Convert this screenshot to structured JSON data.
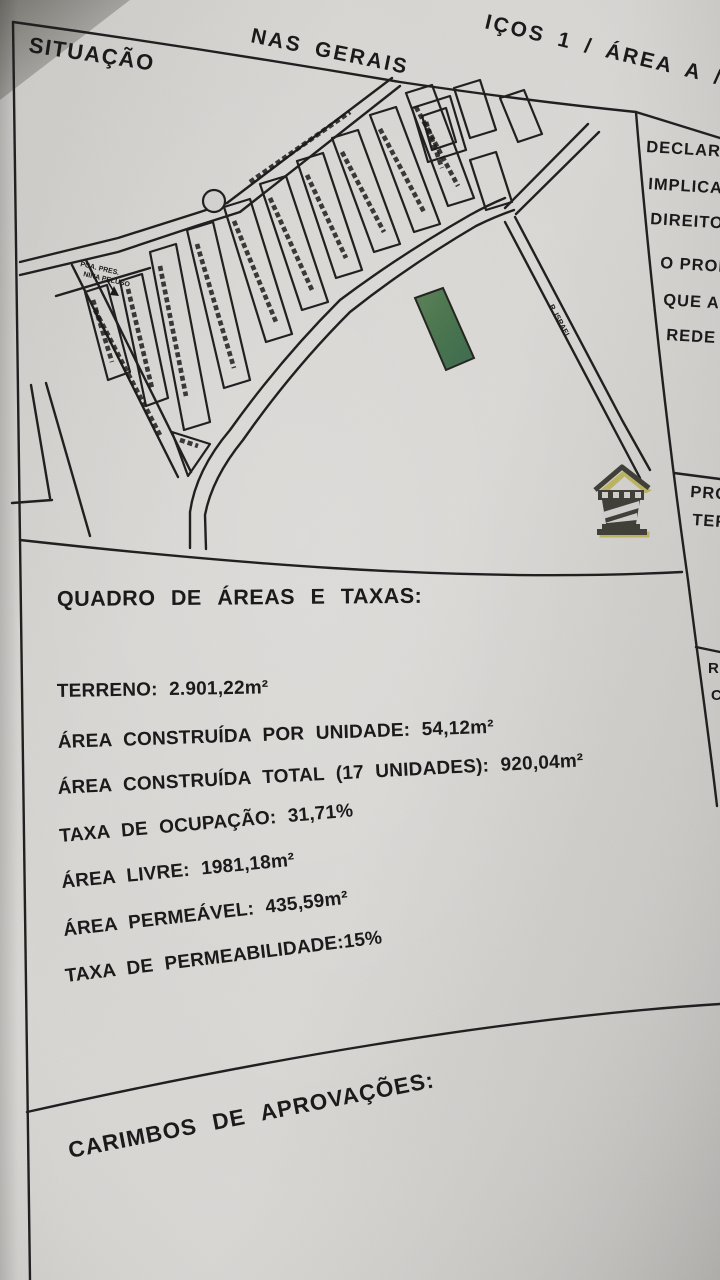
{
  "header": {
    "left_fragment": "NAS GERAIS",
    "right_fragment": "IÇOS 1 / ÁREA A / AV",
    "section_label": "SITUAÇÃO"
  },
  "side_notes": {
    "declaration_lines": [
      "DECLARO",
      "IMPLICA",
      "DIREITO"
    ],
    "owner_lines": [
      "O PROP",
      "QUE AS",
      "REDE"
    ],
    "prop_box_lines": [
      "PRO",
      "TER"
    ],
    "resp_box_lines": [
      "R",
      "C"
    ]
  },
  "map": {
    "plaza_label_line1": "PCA. PRES.",
    "plaza_label_line2": "NINA PELUSO",
    "street_label": "R. ISRAEL",
    "highlight_lot_color": "#47734d"
  },
  "quadro": {
    "title": "QUADRO DE ÁREAS E TAXAS:",
    "lines": [
      "TERRENO: 2.901,22m²",
      "ÁREA CONSTRUÍDA POR UNIDADE: 54,12m²",
      "ÁREA CONSTRUÍDA TOTAL (17 UNIDADES): 920,04m²",
      "TAXA DE OCUPAÇÃO: 31,71%",
      "ÁREA LIVRE: 1981,18m²",
      "ÁREA PERMEÁVEL: 435,59m²",
      "TAXA DE PERMEABILIDADE:15%"
    ]
  },
  "carimbos": {
    "title": "CARIMBOS DE APROVAÇÕES:"
  },
  "colors": {
    "ink": "#1b1b1b",
    "paper": "#d2d1cf",
    "lot_green": "#47734d"
  }
}
